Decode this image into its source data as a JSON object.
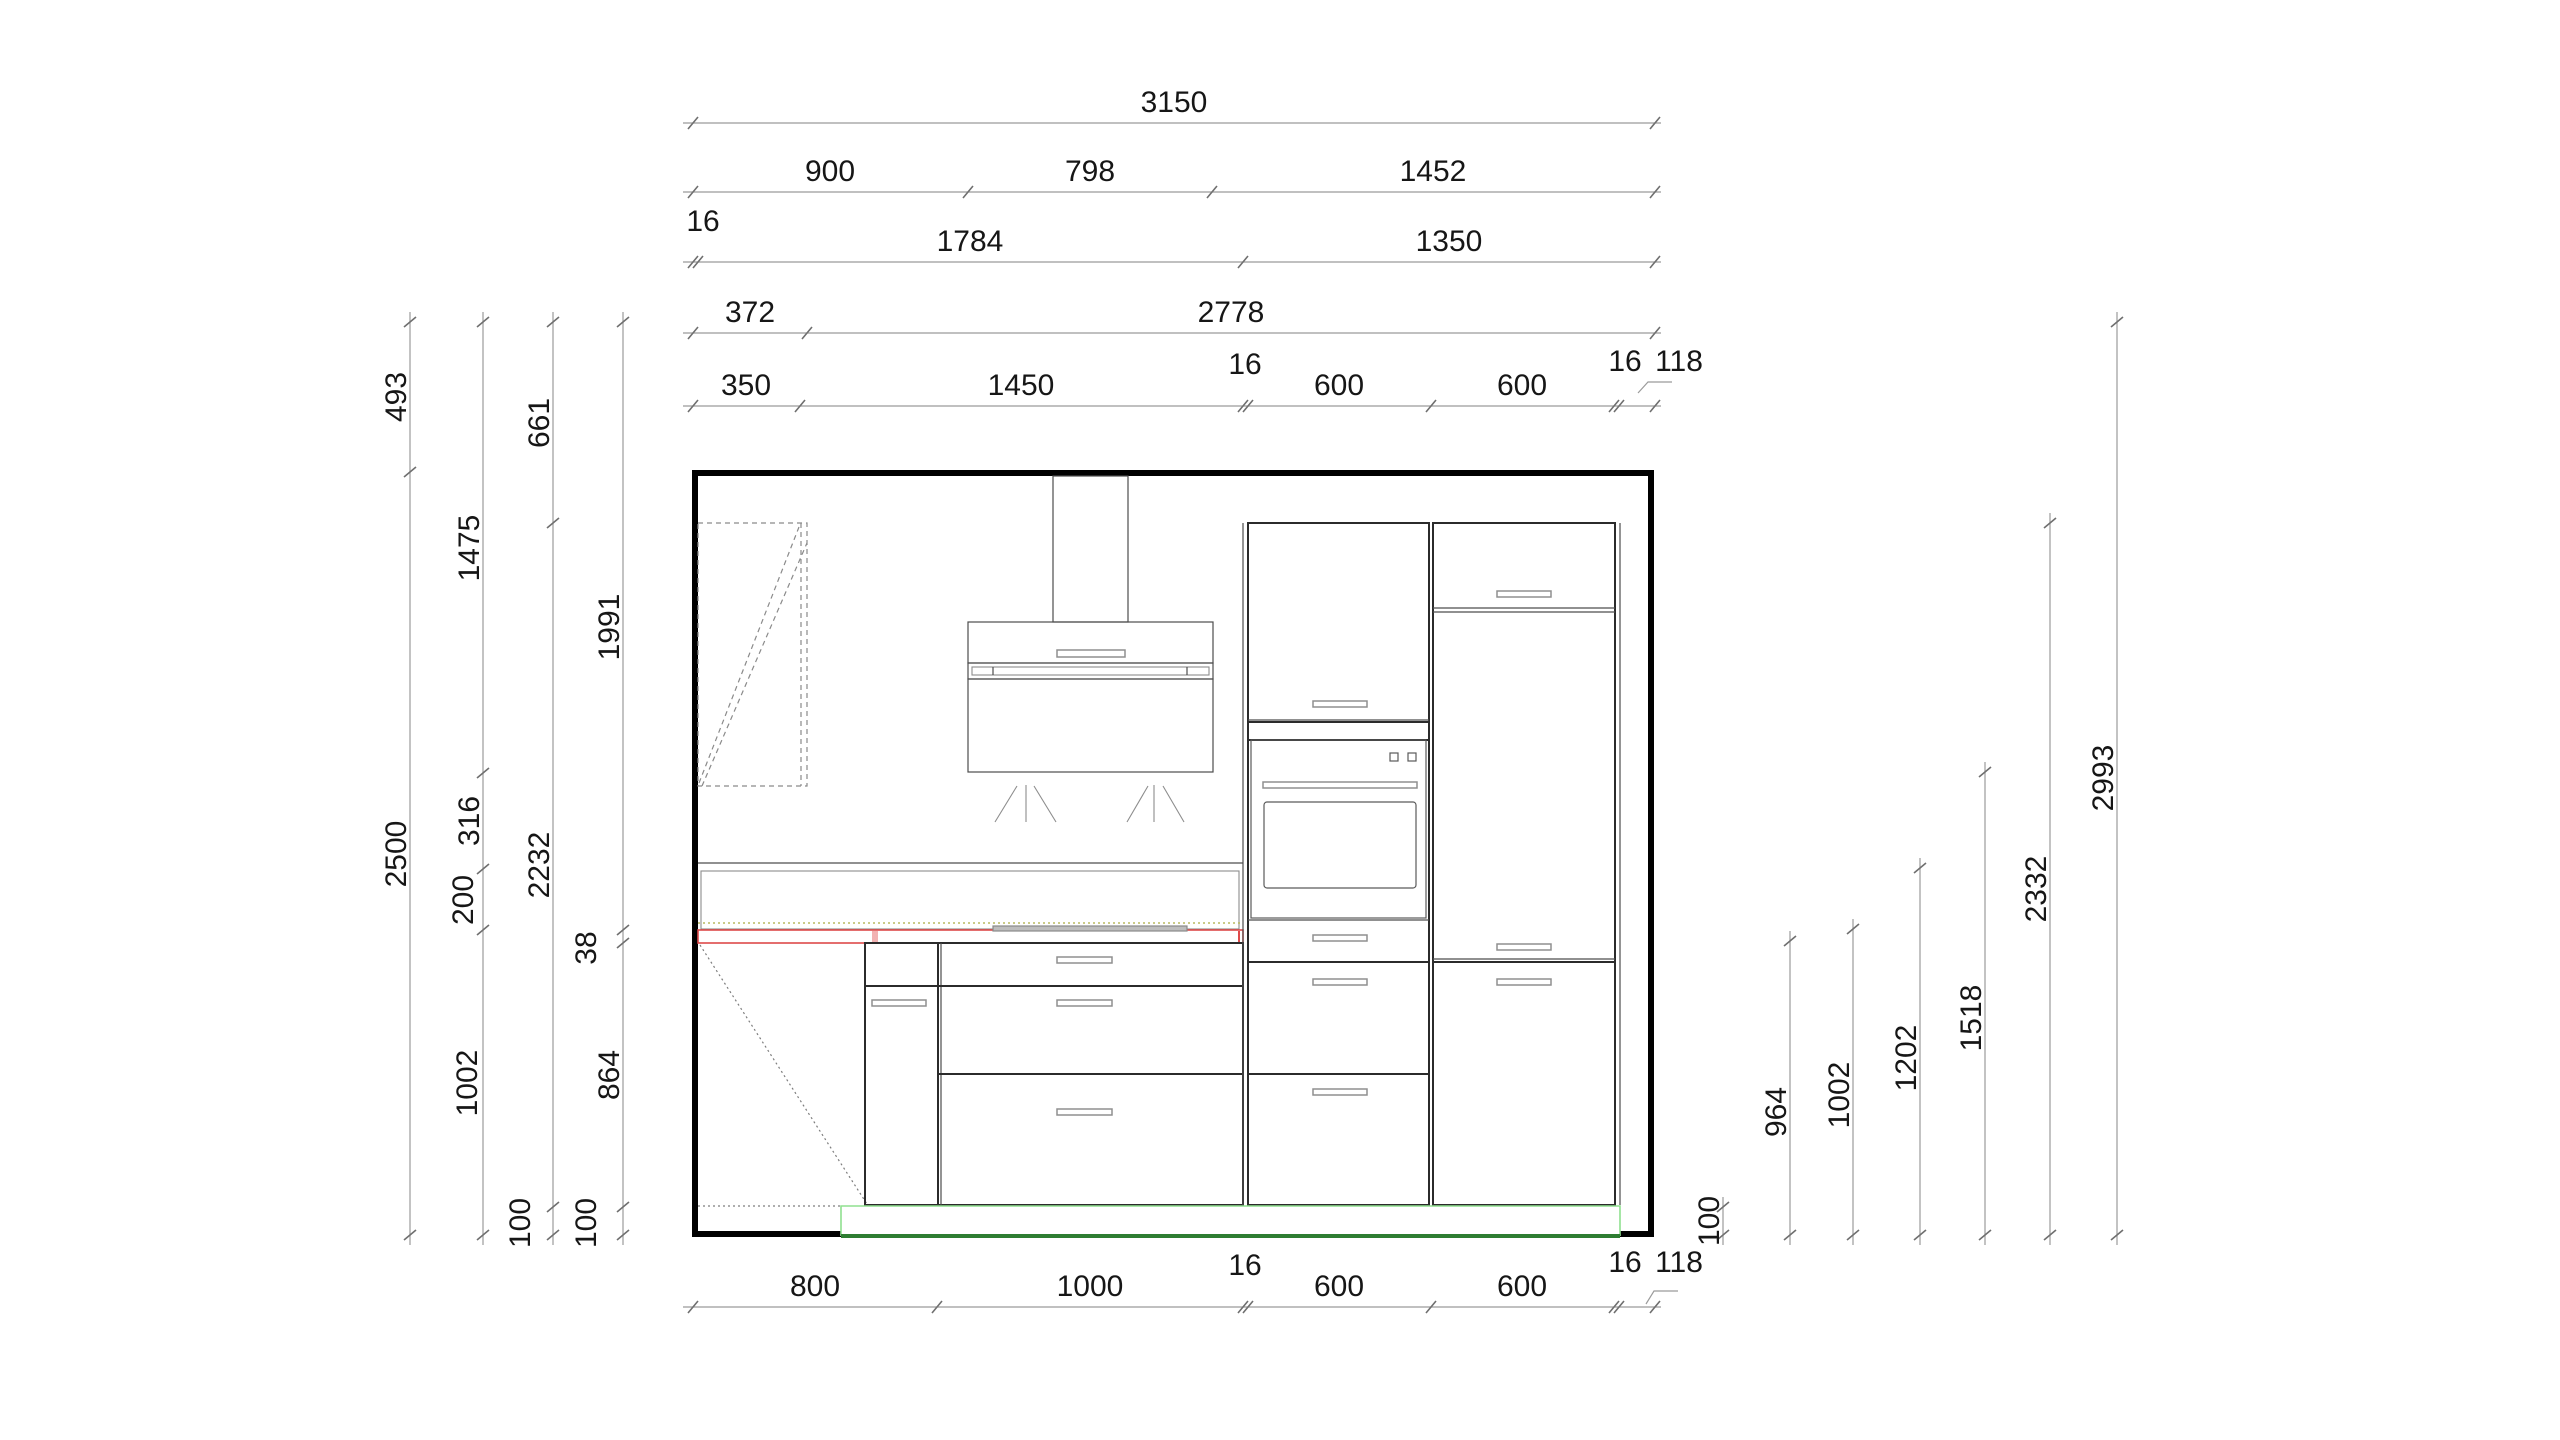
{
  "drawing": {
    "kind": "kitchen-elevation-cad-drawing",
    "units": "mm"
  },
  "dims": {
    "top1": [
      "3150"
    ],
    "top2": [
      "900",
      "798",
      "1452"
    ],
    "top3": [
      "16",
      "1784",
      "1350"
    ],
    "top4": [
      "372",
      "2778"
    ],
    "top5": [
      "350",
      "1450",
      "16",
      "600",
      "600",
      "16",
      "118"
    ],
    "bottom": [
      "800",
      "1000",
      "16",
      "600",
      "600",
      "16",
      "118"
    ],
    "left1": [
      "493",
      "2500"
    ],
    "left2": [
      "1475",
      "316",
      "200",
      "1002"
    ],
    "left3": [
      "661",
      "2232",
      "100"
    ],
    "left4": [
      "1991",
      "38",
      "864",
      "100"
    ],
    "right": [
      "100",
      "964",
      "1002",
      "1202",
      "1518",
      "2332",
      "2993"
    ]
  },
  "colors": {
    "worktop_red": "#de4a4a",
    "worktop_tick_pink": "#f2b2b2",
    "cooktop_gray": "#8a8a8a",
    "plinth_green": "#8fe08f",
    "floor_green": "#2e7d32",
    "niche_dotted_olive": "#b9b960"
  }
}
